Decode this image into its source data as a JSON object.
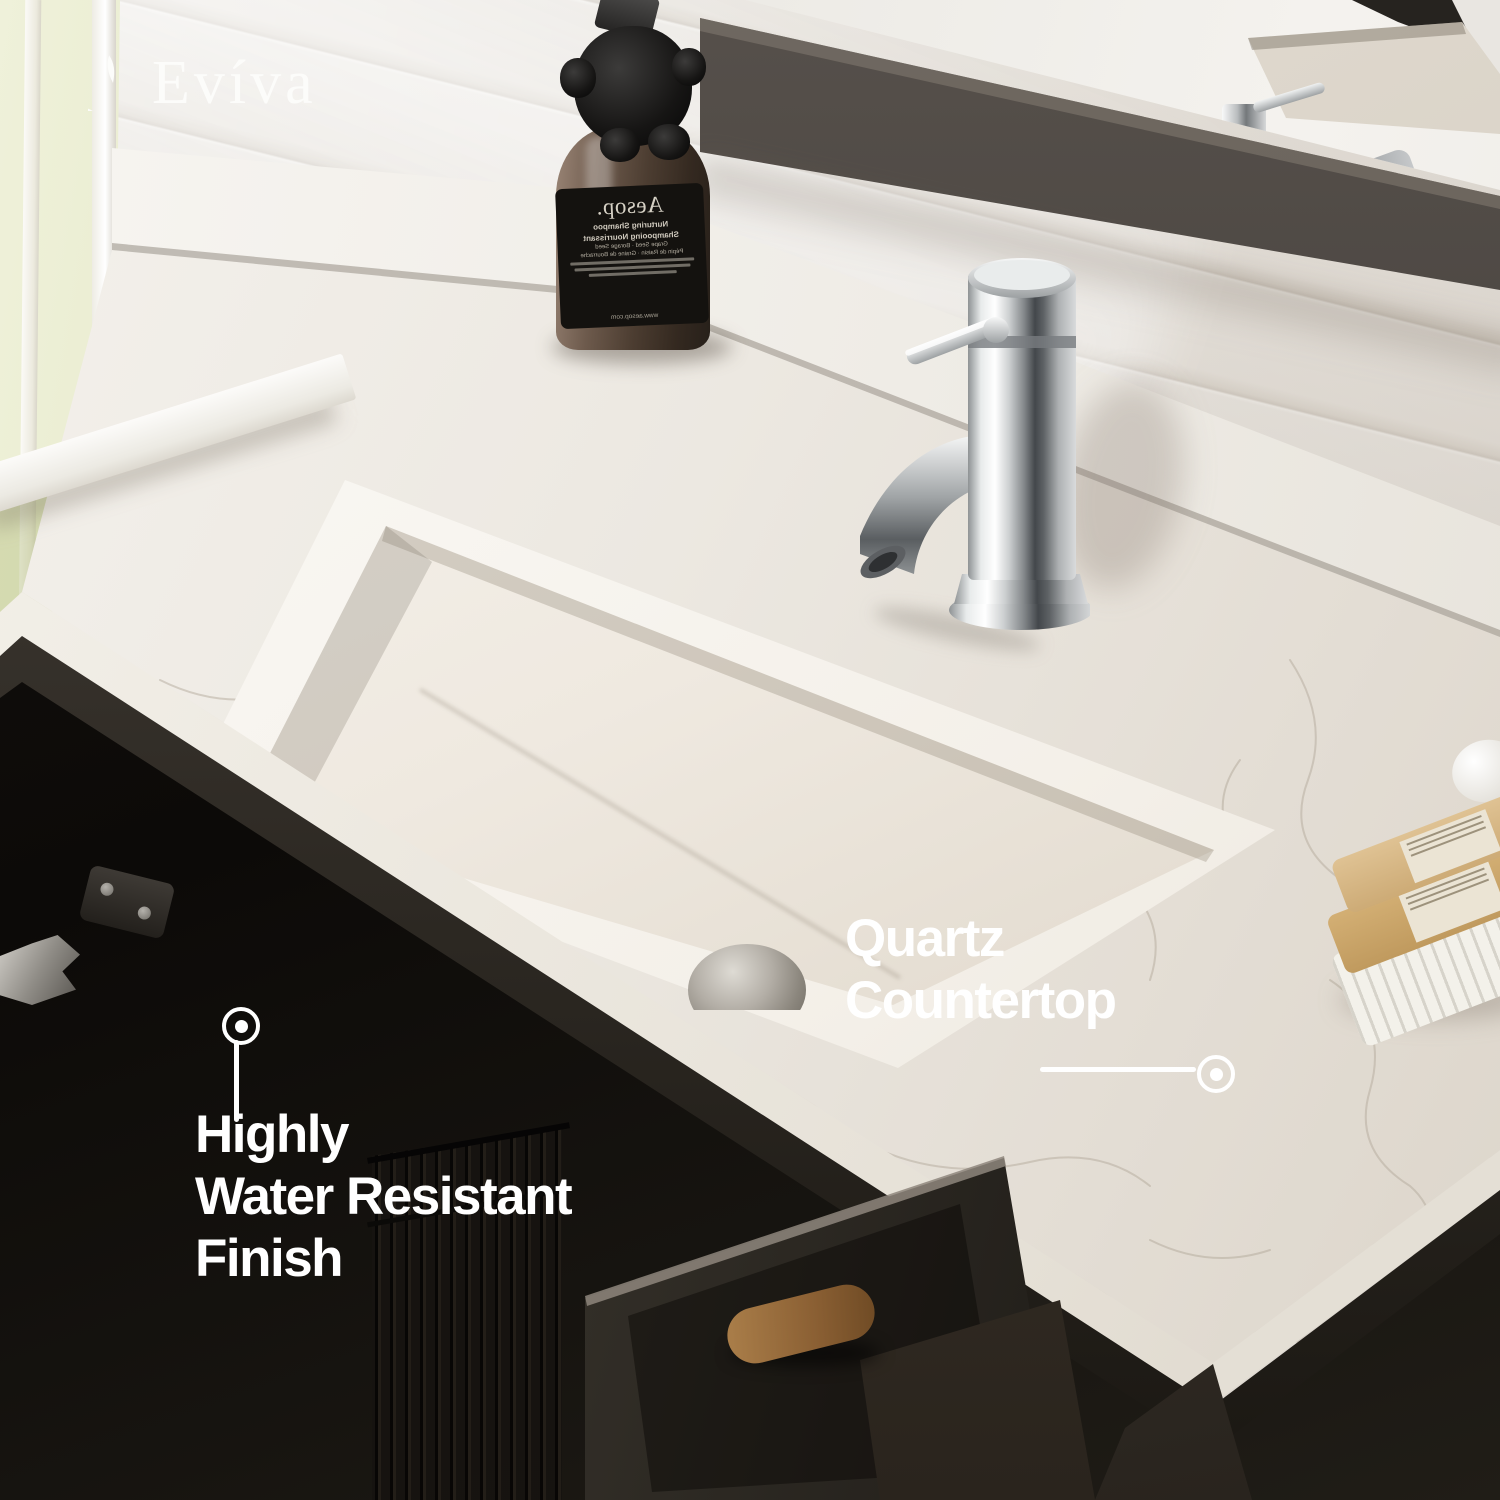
{
  "brand": {
    "logo_text": "Evíva"
  },
  "callouts": {
    "quartz": {
      "line1": "Quartz",
      "line2": "Countertop"
    },
    "water": {
      "line1": "Highly",
      "line2": "Water Resistant",
      "line3": "Finish"
    }
  },
  "bottle": {
    "brand": "Aesop.",
    "product_en": "Nurturing Shampoo",
    "product_fr": "Shampooing Nourrissant",
    "fine_print_en": "Grape Seed · Borage Seed",
    "fine_print_fr": "Pépin de Raisin · Graine de Bourrache",
    "website": "www.aesop.com"
  },
  "colors": {
    "countertop_white": "#efece6",
    "cabinet_black": "#131110",
    "mirror_frame": "#46413d",
    "chrome": "#d9dcdd",
    "bottle_amber": "#5b4a3e",
    "label_black": "#14120f",
    "text_white": "#ffffff",
    "window_green": "#d6dbae"
  }
}
